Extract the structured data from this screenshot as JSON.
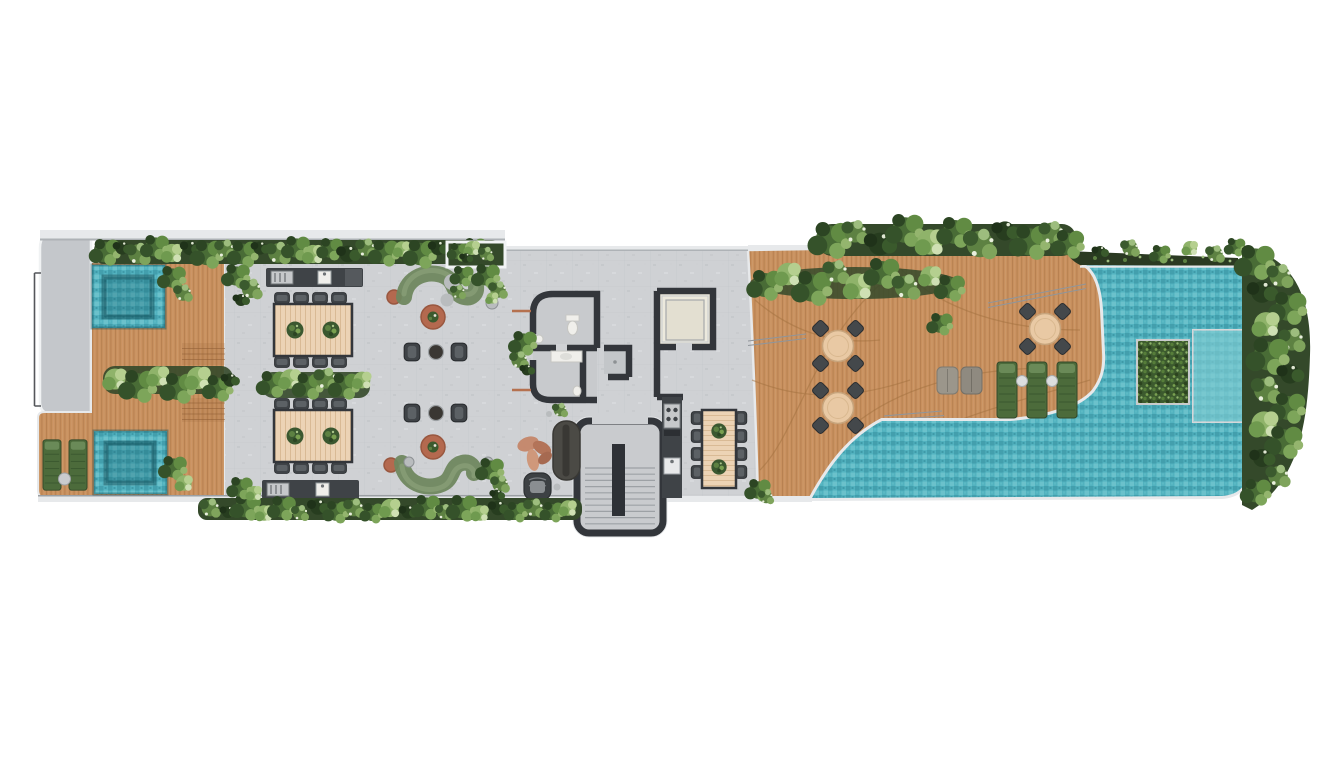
{
  "palette": {
    "background": "#ffffff",
    "concrete": "#cfd1d4",
    "concrete_dark": "#c4c7cb",
    "coping": "#e7e9eb",
    "outline": "#aeb2b6",
    "wall": "#33363b",
    "wood": "#c9915f",
    "wood_line": "#a87243",
    "wood_step": "#8c5a33",
    "table_wood": "#ecd3b5",
    "table_wood_line": "#d9ba95",
    "pool_base": "#52b2bf",
    "pool_dark": "#3d98a6",
    "pool_light": "#78c9d1",
    "pool_ledge": "#7fcbd1",
    "hedge_base": "#3c5a2e",
    "band_base": "#34492a",
    "sofa_green": "#6f875f",
    "sofa_green_light": "#93a982",
    "terracotta": "#b4694f",
    "furniture_dark": "#3f4347",
    "furniture_gray": "#92969a",
    "lounger_green": "#4c6b3b",
    "steel": "#c6c8ca",
    "fixture_white": "#f0efeb",
    "elevator_floor": "#ece9dd",
    "rug_terracotta": "#c58365",
    "planter_dark": "#2b3a22",
    "stone_gray": "#b9bcbe"
  },
  "plan": {
    "regions": {
      "left_terrace": {
        "label": "left terrace deck",
        "plunge_pools": 2,
        "sun_loungers": 2,
        "bbq_stations": 2,
        "dining_tables": 2,
        "seats_per_dining_table": 8,
        "curved_sofas": 2,
        "lounge_armchairs": 4,
        "coffee_tables": 2,
        "side_stools": 2
      },
      "building_core": {
        "label": "building core",
        "bathrooms": 2,
        "elevators": 1,
        "staircases": 1,
        "kitchenettes": 1,
        "dining_table_seats": 8,
        "lounge_sofas": 1,
        "lounge_chairs": 1
      },
      "pool_terrace": {
        "label": "pool deck",
        "bistro_tables": 3,
        "chairs_per_bistro_table": 4,
        "sun_loungers": 3,
        "poufs": 2
      },
      "pool": {
        "label": "swimming pool",
        "planted_islands": 1,
        "submerged_ledges": 1
      }
    }
  }
}
